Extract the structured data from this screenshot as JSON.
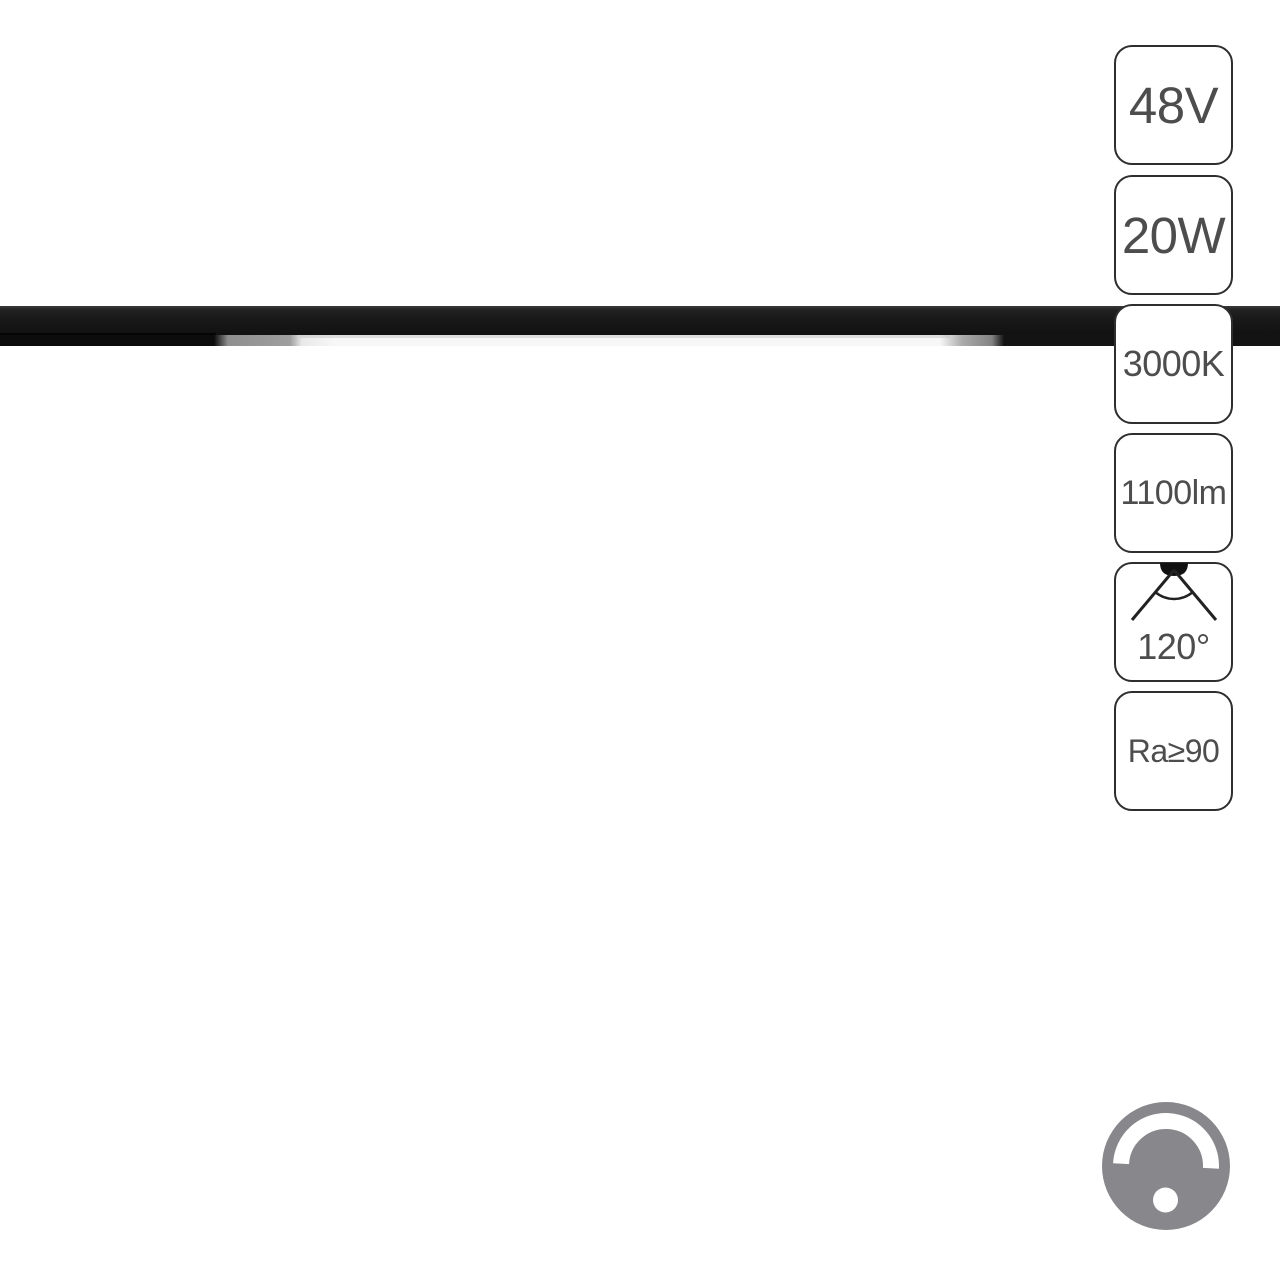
{
  "image": {
    "background": "#ffffff",
    "subject": "black-magnetic-track-linear-led-lamp"
  },
  "badges": [
    {
      "name": "voltage",
      "label": "48V"
    },
    {
      "name": "power",
      "label": "20W"
    },
    {
      "name": "color-temperature",
      "label": "3000K"
    },
    {
      "name": "luminous-flux",
      "label": "1100lm"
    },
    {
      "name": "beam-angle",
      "label": "120°"
    },
    {
      "name": "color-rendering-index",
      "label": "Ra≥90"
    }
  ],
  "icons": {
    "beam_angle": "beam-angle-icon",
    "dimmable": "dimmer-knob-icon"
  },
  "colors": {
    "badge_border": "#2e2e2e",
    "badge_text": "#4d4d4d",
    "track_dark": "#141414",
    "lamp_glow": "#f7f7f7",
    "lamp_endcap_gray": "#9e9e9e",
    "dimmer_gray": "#87878c"
  }
}
